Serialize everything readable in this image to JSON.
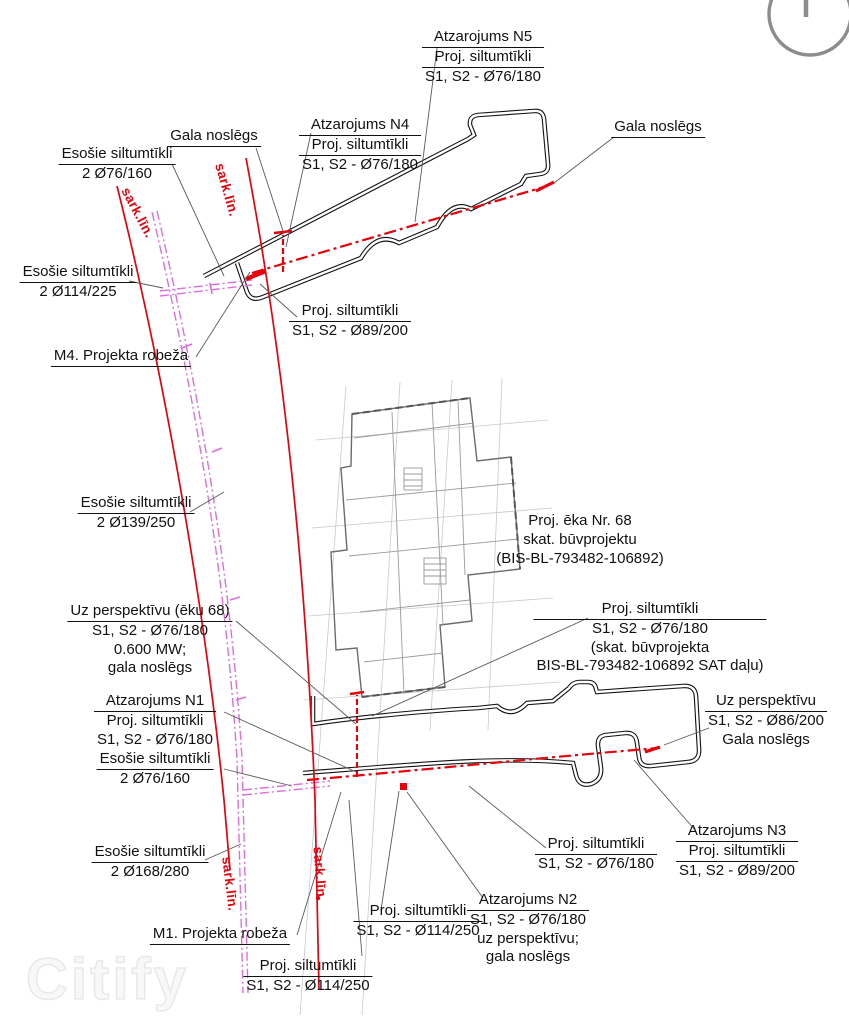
{
  "title": "Siltumtīklu izvietojuma plāns",
  "watermark": "Citify",
  "icons": {
    "north": "north-arrow-icon"
  },
  "colors": {
    "proposed_network": "#e8000a",
    "existing_network": "#dd6fdd",
    "red_line": "#e8000a",
    "road_outline": "#111111",
    "building": "#6b6b6b",
    "leader": "#5a5a5a"
  },
  "labels": [
    {
      "id": "label-atzarojums-n5",
      "x": 483,
      "y": 28,
      "u": [
        0,
        1
      ],
      "lines": [
        "Atzarojums N5",
        "Proj. siltumtīkli",
        "S1, S2 - Ø76/180"
      ]
    },
    {
      "id": "label-gala-noslegs-top-right",
      "x": 658,
      "y": 118,
      "u": [
        0
      ],
      "lines": [
        "Gala noslēgs"
      ]
    },
    {
      "id": "label-gala-noslegs-top-left",
      "x": 214,
      "y": 127,
      "u": [
        0
      ],
      "lines": [
        "Gala noslēgs"
      ]
    },
    {
      "id": "label-atzarojums-n4",
      "x": 360,
      "y": 116,
      "u": [
        0,
        1
      ],
      "lines": [
        "Atzarojums N4",
        "Proj. siltumtīkli",
        "S1, S2 - Ø76/180"
      ]
    },
    {
      "id": "label-esosie-76-160-top",
      "x": 117,
      "y": 145,
      "u": [
        0
      ],
      "lines": [
        "Esošie siltumtīkli",
        "2 Ø76/160"
      ]
    },
    {
      "id": "label-esosie-114-225",
      "x": 78,
      "y": 263,
      "u": [
        0
      ],
      "lines": [
        "Esošie siltumtīkli",
        "2 Ø114/225"
      ]
    },
    {
      "id": "label-m4-projekta-robeza",
      "x": 121,
      "y": 347,
      "u": [
        0
      ],
      "lines": [
        "M4. Projekta robeža"
      ]
    },
    {
      "id": "label-proj-89-200-top",
      "x": 350,
      "y": 302,
      "u": [
        0
      ],
      "lines": [
        "Proj. siltumtīkli",
        "S1, S2 - Ø89/200"
      ]
    },
    {
      "id": "label-esosie-139-250",
      "x": 136,
      "y": 494,
      "u": [
        0
      ],
      "lines": [
        "Esošie siltumtīkli",
        "2 Ø139/250"
      ]
    },
    {
      "id": "label-proj-eka-68",
      "x": 580,
      "y": 512,
      "u": [],
      "lines": [
        "Proj. ēka Nr. 68",
        "skat. būvprojektu",
        "(BIS-BL-793482-106892)"
      ]
    },
    {
      "id": "label-proj-sat-dalu",
      "x": 650,
      "y": 600,
      "u": [
        0
      ],
      "lines": [
        "Proj. siltumtīkli",
        "S1, S2 - Ø76/180",
        "(skat. būvprojekta",
        "BIS-BL-793482-106892 SAT daļu)"
      ]
    },
    {
      "id": "label-uz-perspektivu-eku-68",
      "x": 150,
      "y": 602,
      "u": [
        0
      ],
      "lines": [
        "Uz perspektīvu (ēku 68)",
        "S1, S2 - Ø76/180",
        "0.600 MW;",
        "gala noslēgs"
      ]
    },
    {
      "id": "label-atzarojums-n1",
      "x": 155,
      "y": 692,
      "u": [
        0
      ],
      "lines": [
        "Atzarojums N1",
        "Proj. siltumtīkli",
        "S1, S2 - Ø76/180"
      ]
    },
    {
      "id": "label-esosie-76-160-bottom",
      "x": 155,
      "y": 750,
      "u": [
        0
      ],
      "lines": [
        "Esošie siltumtīkli",
        "2 Ø76/160"
      ]
    },
    {
      "id": "label-uz-perspektivu-right",
      "x": 766,
      "y": 692,
      "u": [
        0
      ],
      "lines": [
        "Uz perspektīvu",
        "S1, S2 - Ø86/200",
        "Gala noslēgs"
      ]
    },
    {
      "id": "label-esosie-168-280",
      "x": 150,
      "y": 843,
      "u": [
        0
      ],
      "lines": [
        "Esošie siltumtīkli",
        "2 Ø168/280"
      ]
    },
    {
      "id": "label-m1-projekta-robeza",
      "x": 220,
      "y": 925,
      "u": [
        0
      ],
      "lines": [
        "M1. Projekta robeža"
      ]
    },
    {
      "id": "label-proj-114-250-mid",
      "x": 418,
      "y": 902,
      "u": [
        0
      ],
      "lines": [
        "Proj. siltumtīkli",
        "S1, S2 - Ø114/250"
      ]
    },
    {
      "id": "label-proj-114-250-bottom",
      "x": 308,
      "y": 957,
      "u": [
        0
      ],
      "lines": [
        "Proj. siltumtīkli",
        "S1, S2 - Ø114/250"
      ]
    },
    {
      "id": "label-atzarojums-n2",
      "x": 528,
      "y": 891,
      "u": [
        0
      ],
      "lines": [
        "Atzarojums N2",
        "S1, S2 - Ø76/180",
        "uz perspektīvu;",
        "gala noslēgs"
      ]
    },
    {
      "id": "label-proj-76-180-bottom",
      "x": 596,
      "y": 835,
      "u": [
        0
      ],
      "lines": [
        "Proj. siltumtīkli",
        "S1, S2 - Ø76/180"
      ]
    },
    {
      "id": "label-atzarojums-n3",
      "x": 737,
      "y": 822,
      "u": [
        0,
        1
      ],
      "lines": [
        "Atzarojums N3",
        "Proj. siltumtīkli",
        "S1, S2 - Ø89/200"
      ]
    },
    {
      "id": "label-sark-lin-top-left",
      "x": 137,
      "y": 213,
      "rot": 62,
      "color": "#e8000a",
      "lines": [
        "sark.līn."
      ]
    },
    {
      "id": "label-sark-lin-top-mid",
      "x": 226,
      "y": 190,
      "rot": 74,
      "color": "#e8000a",
      "lines": [
        "sark.līn."
      ]
    },
    {
      "id": "label-sark-lin-bottom-left",
      "x": 229,
      "y": 884,
      "rot": 83,
      "color": "#e8000a",
      "lines": [
        "sark.līn."
      ]
    },
    {
      "id": "label-sark-lin-bottom-mid",
      "x": 319,
      "y": 874,
      "rot": 86,
      "color": "#e8000a",
      "lines": [
        "sark.līn."
      ]
    }
  ]
}
